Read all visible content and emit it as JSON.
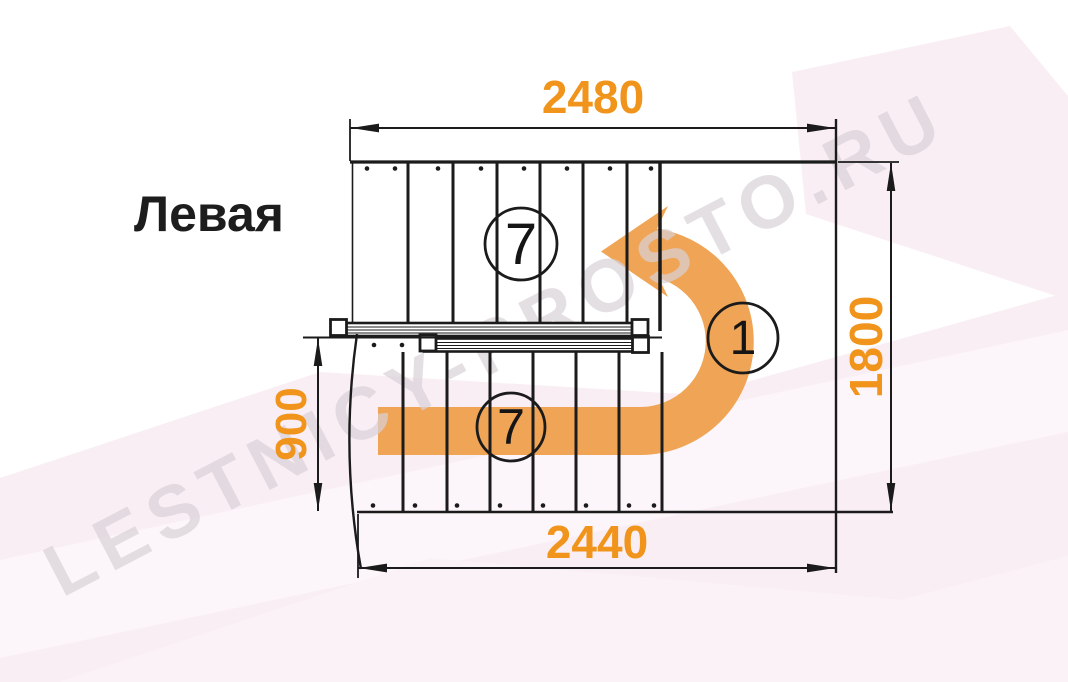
{
  "title": "Левая",
  "dimensions": {
    "top_width": "2480",
    "bottom_width": "2440",
    "right_height": "1800",
    "left_height": "900"
  },
  "flight_labels": {
    "top_flight_steps": "7",
    "bottom_flight_steps": "7",
    "landing_number": "1"
  },
  "watermark": "LESTNICY-PROSTO.RU",
  "colors": {
    "dimension_text": "#f0941c",
    "turn_arrow": "#f0a455",
    "linework": "#1b1b1b",
    "background": "#ffffff",
    "background_tint": "#f9eef4",
    "watermark_color": "#d9d2d8"
  }
}
